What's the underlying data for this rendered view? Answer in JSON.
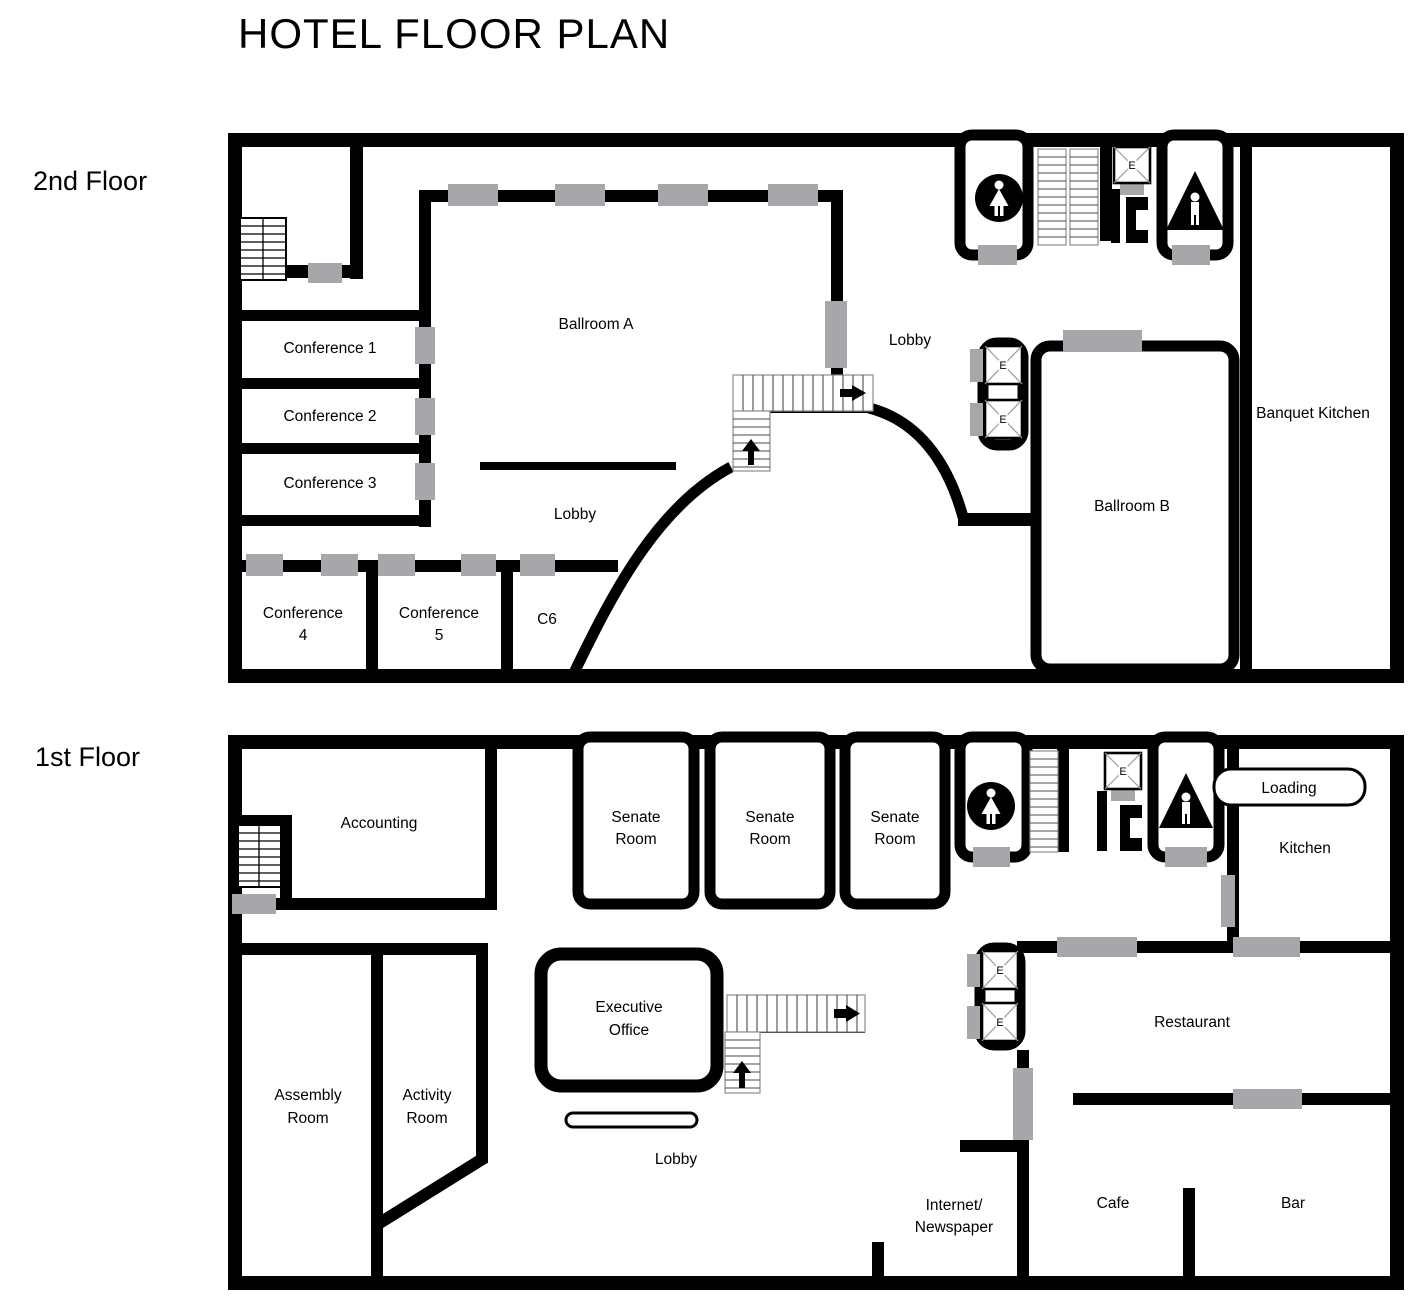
{
  "title": "HOTEL FLOOR PLAN",
  "elevator_letter": "E",
  "colors": {
    "wall": "#000000",
    "door": "#a7a7ab",
    "background": "#ffffff"
  },
  "floor2": {
    "label": "2nd Floor",
    "ballroom_a": "Ballroom A",
    "ballroom_b": "Ballroom B",
    "banquet_kitchen": "Banquet Kitchen",
    "conference_1": "Conference 1",
    "conference_2": "Conference 2",
    "conference_3": "Conference 3",
    "conference_4": [
      "Conference",
      "4"
    ],
    "conference_5": [
      "Conference",
      "5"
    ],
    "c6": "C6",
    "lobby": "Lobby"
  },
  "floor1": {
    "label": "1st Floor",
    "accounting": "Accounting",
    "senate_room": [
      "Senate",
      "Room"
    ],
    "loading": "Loading",
    "kitchen": "Kitchen",
    "assembly_room": [
      "Assembly",
      "Room"
    ],
    "activity_room": [
      "Activity",
      "Room"
    ],
    "executive_office": [
      "Executive",
      "Office"
    ],
    "lobby": "Lobby",
    "internet_newspaper": [
      "Internet/",
      "Newspaper"
    ],
    "cafe": "Cafe",
    "bar": "Bar",
    "restaurant": "Restaurant"
  }
}
